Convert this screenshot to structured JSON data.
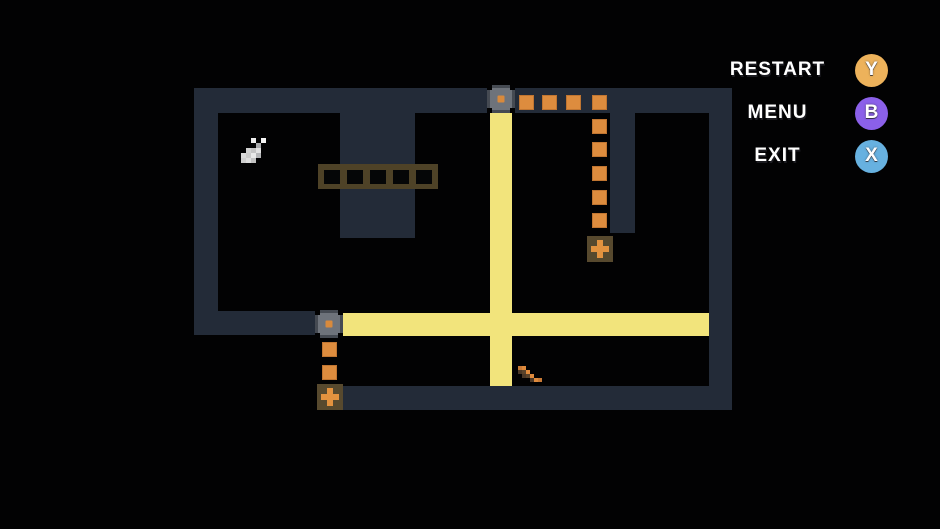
{
  "menu": {
    "items": [
      {
        "id": "restart",
        "label": "RESTART",
        "key": "Y",
        "key_color": "#edb25b",
        "top": 53
      },
      {
        "id": "menu",
        "label": "MENU",
        "key": "B",
        "key_color": "#8b60e9",
        "top": 96
      },
      {
        "id": "exit",
        "label": "EXIT",
        "key": "X",
        "key_color": "#67b1e0",
        "top": 139
      }
    ]
  },
  "colors": {
    "background": "#020203",
    "wall": "#232b38",
    "beam": "#f2e47c",
    "dot": "#dd8c3e",
    "dot_edge": "#c07531",
    "pad_bg": "#57492e",
    "plus": "#e3923f",
    "bridge_frame": "#4e4227",
    "emitter_base": "#454a52",
    "emitter_body": "#6e737b",
    "emitter_dot": "#d98a3c"
  },
  "level": {
    "walls": [
      {
        "x": 194,
        "y": 88,
        "w": 538,
        "h": 25
      },
      {
        "x": 194,
        "y": 88,
        "w": 24,
        "h": 247
      },
      {
        "x": 194,
        "y": 311,
        "w": 124,
        "h": 24
      },
      {
        "x": 317,
        "y": 386,
        "w": 415,
        "h": 24
      },
      {
        "x": 709,
        "y": 88,
        "w": 23,
        "h": 322
      },
      {
        "x": 340,
        "y": 113,
        "w": 75,
        "h": 125
      },
      {
        "x": 610,
        "y": 113,
        "w": 25,
        "h": 120
      }
    ],
    "beams": [
      {
        "x": 490,
        "y": 112,
        "w": 22,
        "h": 274
      },
      {
        "x": 342,
        "y": 313,
        "w": 367,
        "h": 23
      }
    ],
    "emitters": [
      {
        "x": 487,
        "y": 85,
        "w": 28,
        "h": 28
      },
      {
        "x": 315,
        "y": 310,
        "w": 28,
        "h": 28
      }
    ],
    "dots": [
      {
        "x": 519,
        "y": 95
      },
      {
        "x": 542,
        "y": 95
      },
      {
        "x": 566,
        "y": 95
      },
      {
        "x": 592,
        "y": 95
      },
      {
        "x": 592,
        "y": 119
      },
      {
        "x": 592,
        "y": 142
      },
      {
        "x": 592,
        "y": 166
      },
      {
        "x": 592,
        "y": 190
      },
      {
        "x": 592,
        "y": 213
      },
      {
        "x": 322,
        "y": 342
      },
      {
        "x": 322,
        "y": 365
      }
    ],
    "dot_size": 15,
    "pads": [
      {
        "x": 587,
        "y": 236
      },
      {
        "x": 317,
        "y": 384
      }
    ],
    "pad_size": 26,
    "bridge": {
      "x": 318,
      "y": 164,
      "w": 120,
      "h": 25,
      "cells": 5
    },
    "items": [
      {
        "name": "white-boots-item",
        "x": 241,
        "y": 138,
        "unit": 5,
        "pixels": [
          [
            2,
            0,
            "#ededed"
          ],
          [
            4,
            0,
            "#f5f5f5"
          ],
          [
            3,
            1,
            "#a8a9ab"
          ],
          [
            1,
            2,
            "#d2d2d2"
          ],
          [
            2,
            2,
            "#c4c4c4"
          ],
          [
            3,
            2,
            "#e2e2e2"
          ],
          [
            0,
            3,
            "#dadada"
          ],
          [
            1,
            3,
            "#cbcbcb"
          ],
          [
            2,
            3,
            "#e9e9e9"
          ],
          [
            3,
            3,
            "#b5b6b8"
          ],
          [
            0,
            4,
            "#cfcfcf"
          ],
          [
            1,
            4,
            "#dedede"
          ],
          [
            2,
            4,
            "#c2c2c2"
          ]
        ]
      },
      {
        "name": "stairs-item",
        "x": 518,
        "y": 366,
        "unit": 4,
        "pixels": [
          [
            0,
            0,
            "#c97a36"
          ],
          [
            1,
            0,
            "#de8a3d"
          ],
          [
            0,
            1,
            "#4a3726"
          ],
          [
            1,
            1,
            "#5a432b"
          ],
          [
            2,
            1,
            "#de8a3d"
          ],
          [
            1,
            2,
            "#4a3726"
          ],
          [
            2,
            2,
            "#5a432b"
          ],
          [
            3,
            2,
            "#de8a3d"
          ],
          [
            3,
            3,
            "#4a3726"
          ],
          [
            4,
            3,
            "#de8a3d"
          ],
          [
            5,
            3,
            "#c97a36"
          ]
        ]
      }
    ]
  }
}
